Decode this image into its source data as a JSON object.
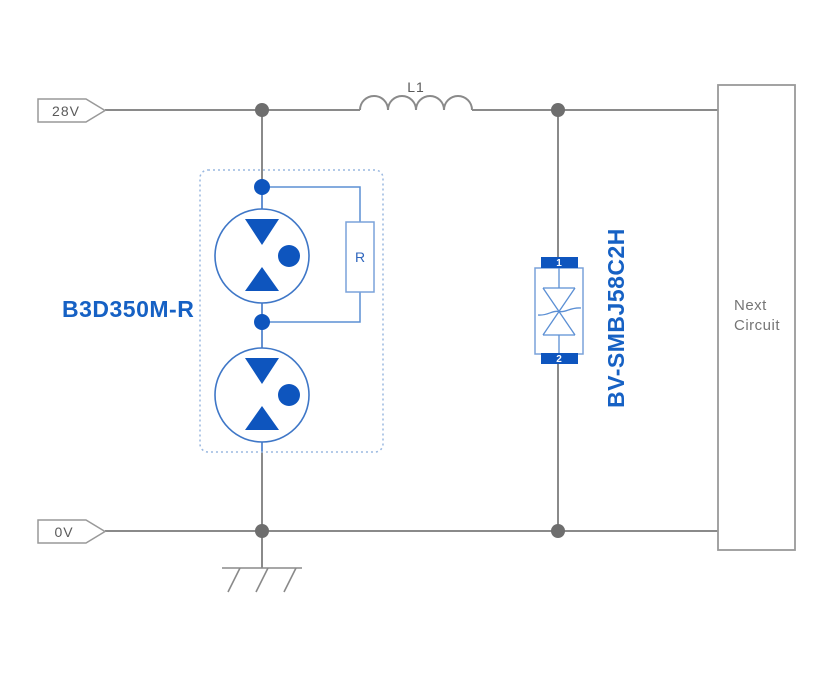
{
  "diagram": {
    "title": "surge-protection-circuit",
    "rails": {
      "top_label": "28V",
      "bottom_label": "0V"
    },
    "inductor": {
      "label": "L1"
    },
    "gdt_module": {
      "label": "B3D350M-R",
      "resistor_label": "R"
    },
    "tvs": {
      "label": "BV-SMBJ58C2H",
      "pin1": "1",
      "pin2": "2"
    },
    "next_circuit": {
      "line1": "Next",
      "line2": "Circuit"
    },
    "colors": {
      "wire_gray": "#8a8a8a",
      "junction_gray": "#6e6e6e",
      "tag_border": "#999999",
      "blue_fill": "#0e55be",
      "blue_stroke_dark": "#3f77c7",
      "blue_stroke_light": "#7aa2da",
      "blue_symbol": "#5b8fd4",
      "dashed_border": "#9ab8e0",
      "label_blue": "#1661c4",
      "text_gray": "#5a5a5a",
      "next_text_gray": "#757575"
    }
  }
}
